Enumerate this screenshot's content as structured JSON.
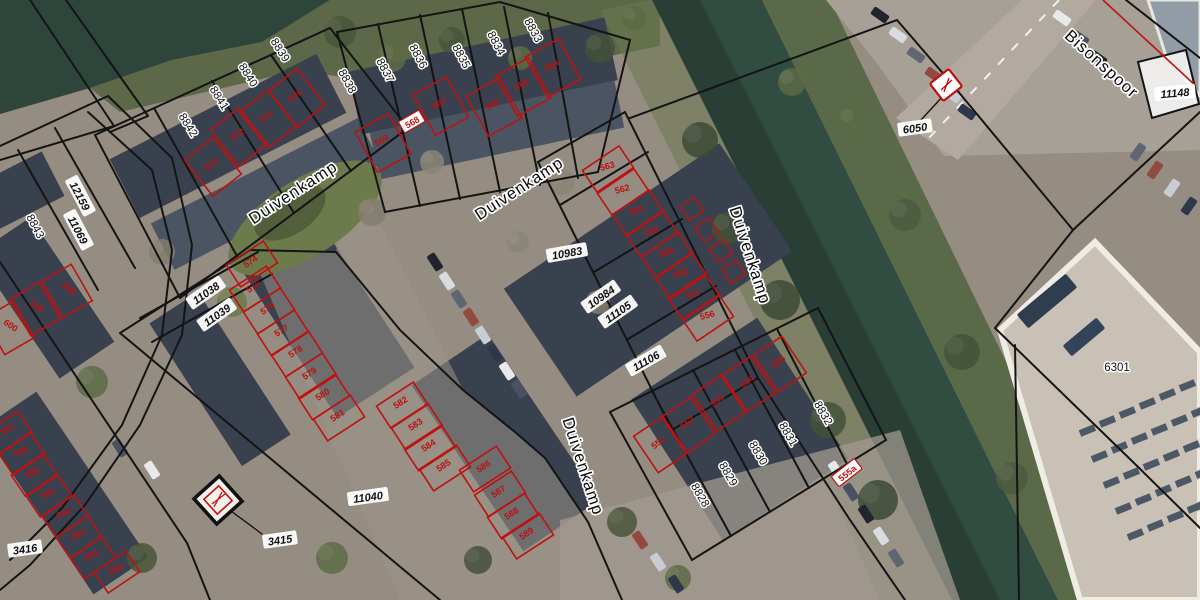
{
  "map": {
    "title": "Cadastral aerial map",
    "street_labels": [
      {
        "t": "Duivenkamp",
        "x": 296,
        "y": 197,
        "r": -33
      },
      {
        "t": "Duivenkamp",
        "x": 522,
        "y": 193,
        "r": -33
      },
      {
        "t": "Duivenkamp",
        "x": 745,
        "y": 257,
        "r": 72
      },
      {
        "t": "Duivenkamp",
        "x": 578,
        "y": 468,
        "r": 72
      },
      {
        "t": "Bisonspoor",
        "x": 1098,
        "y": 68,
        "r": 42
      }
    ],
    "parcel_labels": [
      {
        "t": "8843",
        "x": 32,
        "y": 228,
        "r": 62
      },
      {
        "t": "8842",
        "x": 185,
        "y": 127,
        "r": 58
      },
      {
        "t": "8841",
        "x": 216,
        "y": 100,
        "r": 58
      },
      {
        "t": "8840",
        "x": 245,
        "y": 77,
        "r": 58
      },
      {
        "t": "8839",
        "x": 277,
        "y": 52,
        "r": 58
      },
      {
        "t": "8838",
        "x": 344,
        "y": 83,
        "r": 62
      },
      {
        "t": "8837",
        "x": 382,
        "y": 72,
        "r": 62
      },
      {
        "t": "8836",
        "x": 415,
        "y": 58,
        "r": 62
      },
      {
        "t": "8835",
        "x": 458,
        "y": 58,
        "r": 62
      },
      {
        "t": "8834",
        "x": 493,
        "y": 45,
        "r": 62
      },
      {
        "t": "8833",
        "x": 530,
        "y": 32,
        "r": 62
      },
      {
        "t": "8828",
        "x": 697,
        "y": 497,
        "r": 60
      },
      {
        "t": "8829",
        "x": 725,
        "y": 476,
        "r": 60
      },
      {
        "t": "8830",
        "x": 755,
        "y": 455,
        "r": 60
      },
      {
        "t": "8831",
        "x": 785,
        "y": 436,
        "r": 60
      },
      {
        "t": "8832",
        "x": 820,
        "y": 415,
        "r": 60
      },
      {
        "t": "6301",
        "x": 1117,
        "y": 371,
        "r": 0
      }
    ],
    "boxed_parcel_labels": [
      {
        "t": "12159",
        "x": 80,
        "y": 196,
        "r": 62
      },
      {
        "t": "11069",
        "x": 78,
        "y": 230,
        "r": 62
      },
      {
        "t": "11038",
        "x": 206,
        "y": 293,
        "r": -35
      },
      {
        "t": "11039",
        "x": 217,
        "y": 315,
        "r": -35
      },
      {
        "t": "10983",
        "x": 567,
        "y": 253,
        "r": -10
      },
      {
        "t": "10984",
        "x": 601,
        "y": 297,
        "r": -35
      },
      {
        "t": "11105",
        "x": 618,
        "y": 312,
        "r": -35
      },
      {
        "t": "11106",
        "x": 646,
        "y": 361,
        "r": -30
      },
      {
        "t": "11040",
        "x": 368,
        "y": 497,
        "r": -8
      },
      {
        "t": "3416",
        "x": 25,
        "y": 549,
        "r": -8
      },
      {
        "t": "3415",
        "x": 280,
        "y": 540,
        "r": -8
      },
      {
        "t": "11148",
        "x": 1175,
        "y": 93,
        "r": -5
      },
      {
        "t": "6050",
        "x": 915,
        "y": 128,
        "r": -8
      }
    ],
    "house_numbers": [
      {
        "t": "570",
        "x": 297,
        "y": 98,
        "r": -35,
        "blk": "a"
      },
      {
        "t": "571",
        "x": 268,
        "y": 119,
        "r": -35,
        "blk": "a"
      },
      {
        "t": "572",
        "x": 239,
        "y": 137,
        "r": -35,
        "blk": "a"
      },
      {
        "t": "573",
        "x": 213,
        "y": 167,
        "r": -35,
        "blk": "a"
      },
      {
        "t": "564",
        "x": 553,
        "y": 68,
        "r": -30,
        "blk": "b"
      },
      {
        "t": "565",
        "x": 523,
        "y": 87,
        "r": -30,
        "blk": "b"
      },
      {
        "t": "566",
        "x": 494,
        "y": 107,
        "r": -30,
        "blk": "b"
      },
      {
        "t": "567",
        "x": 441,
        "y": 106,
        "r": -30,
        "blk": "b"
      },
      {
        "t": "569",
        "x": 383,
        "y": 143,
        "r": -30,
        "blk": "b"
      },
      {
        "t": "563",
        "x": 608,
        "y": 169,
        "r": -15,
        "blk": "m"
      },
      {
        "t": "562",
        "x": 623,
        "y": 192,
        "r": -15,
        "blk": "m"
      },
      {
        "t": "561",
        "x": 638,
        "y": 213,
        "r": -15,
        "blk": "m"
      },
      {
        "t": "560",
        "x": 652,
        "y": 234,
        "r": -15,
        "blk": "m"
      },
      {
        "t": "559",
        "x": 667,
        "y": 255,
        "r": -15,
        "blk": "m"
      },
      {
        "t": "558",
        "x": 681,
        "y": 276,
        "r": -15,
        "blk": "m"
      },
      {
        "t": "557",
        "x": 694,
        "y": 297,
        "r": -15,
        "blk": "m"
      },
      {
        "t": "556",
        "x": 708,
        "y": 318,
        "r": -15,
        "blk": "m"
      },
      {
        "t": "574",
        "x": 252,
        "y": 264,
        "r": -33,
        "blk": "r"
      },
      {
        "t": "575",
        "x": 255,
        "y": 289,
        "r": -33,
        "blk": "r"
      },
      {
        "t": "576",
        "x": 269,
        "y": 311,
        "r": -33,
        "blk": "r"
      },
      {
        "t": "577",
        "x": 283,
        "y": 333,
        "r": -33,
        "blk": "r"
      },
      {
        "t": "578",
        "x": 297,
        "y": 354,
        "r": -33,
        "blk": "r"
      },
      {
        "t": "579",
        "x": 311,
        "y": 376,
        "r": -33,
        "blk": "r"
      },
      {
        "t": "580",
        "x": 324,
        "y": 397,
        "r": -33,
        "blk": "r"
      },
      {
        "t": "581",
        "x": 339,
        "y": 418,
        "r": -33,
        "blk": "r"
      },
      {
        "t": "582",
        "x": 402,
        "y": 405,
        "r": -33,
        "blk": "r"
      },
      {
        "t": "583",
        "x": 417,
        "y": 427,
        "r": -33,
        "blk": "r"
      },
      {
        "t": "584",
        "x": 430,
        "y": 448,
        "r": -33,
        "blk": "r"
      },
      {
        "t": "585",
        "x": 445,
        "y": 468,
        "r": -33,
        "blk": "r"
      },
      {
        "t": "586",
        "x": 485,
        "y": 469,
        "r": -33,
        "blk": "r"
      },
      {
        "t": "587",
        "x": 500,
        "y": 494,
        "r": -33,
        "blk": "r"
      },
      {
        "t": "588",
        "x": 513,
        "y": 516,
        "r": -33,
        "blk": "r"
      },
      {
        "t": "589",
        "x": 528,
        "y": 536,
        "r": -33,
        "blk": "r"
      },
      {
        "t": "590",
        "x": 117,
        "y": 572,
        "r": -25,
        "blk": "bl"
      },
      {
        "t": "591",
        "x": 93,
        "y": 558,
        "r": -25,
        "blk": "bl"
      },
      {
        "t": "592",
        "x": 79,
        "y": 537,
        "r": -25,
        "blk": "bl"
      },
      {
        "t": "593",
        "x": 65,
        "y": 516,
        "r": -25,
        "blk": "bl"
      },
      {
        "t": "594",
        "x": 49,
        "y": 496,
        "r": -25,
        "blk": "bl"
      },
      {
        "t": "595",
        "x": 34,
        "y": 475,
        "r": -25,
        "blk": "bl"
      },
      {
        "t": "596",
        "x": 22,
        "y": 454,
        "r": -25,
        "blk": "bl"
      },
      {
        "t": "597",
        "x": 9,
        "y": 432,
        "r": -25,
        "blk": "bl"
      },
      {
        "t": "598",
        "x": 67,
        "y": 291,
        "r": 35,
        "blk": "lc"
      },
      {
        "t": "599",
        "x": 35,
        "y": 309,
        "r": 35,
        "blk": "lc"
      },
      {
        "t": "600",
        "x": 9,
        "y": 328,
        "r": 35,
        "blk": "lc"
      },
      {
        "t": "551",
        "x": 660,
        "y": 445,
        "r": -38,
        "blk": "bm"
      },
      {
        "t": "552",
        "x": 689,
        "y": 425,
        "r": -38,
        "blk": "bm"
      },
      {
        "t": "553",
        "x": 719,
        "y": 403,
        "r": -38,
        "blk": "bm"
      },
      {
        "t": "554",
        "x": 749,
        "y": 384,
        "r": -38,
        "blk": "bm"
      },
      {
        "t": "555",
        "x": 780,
        "y": 364,
        "r": -38,
        "blk": "bm"
      }
    ],
    "boxed_house_numbers": [
      {
        "t": "568",
        "x": 412,
        "y": 122,
        "r": -30
      },
      {
        "t": "555a",
        "x": 847,
        "y": 473,
        "r": -38
      }
    ],
    "symbols": [
      {
        "name": "substation-symbol-6050",
        "x": 947,
        "y": 86
      },
      {
        "name": "substation-symbol-3415",
        "x": 218,
        "y": 500
      }
    ],
    "colors": {
      "parcel_line": "#141414",
      "building_outline": "#c01111",
      "water": "#2e453b",
      "label_halo": "#ffffff",
      "red_number": "#bb1111"
    }
  }
}
